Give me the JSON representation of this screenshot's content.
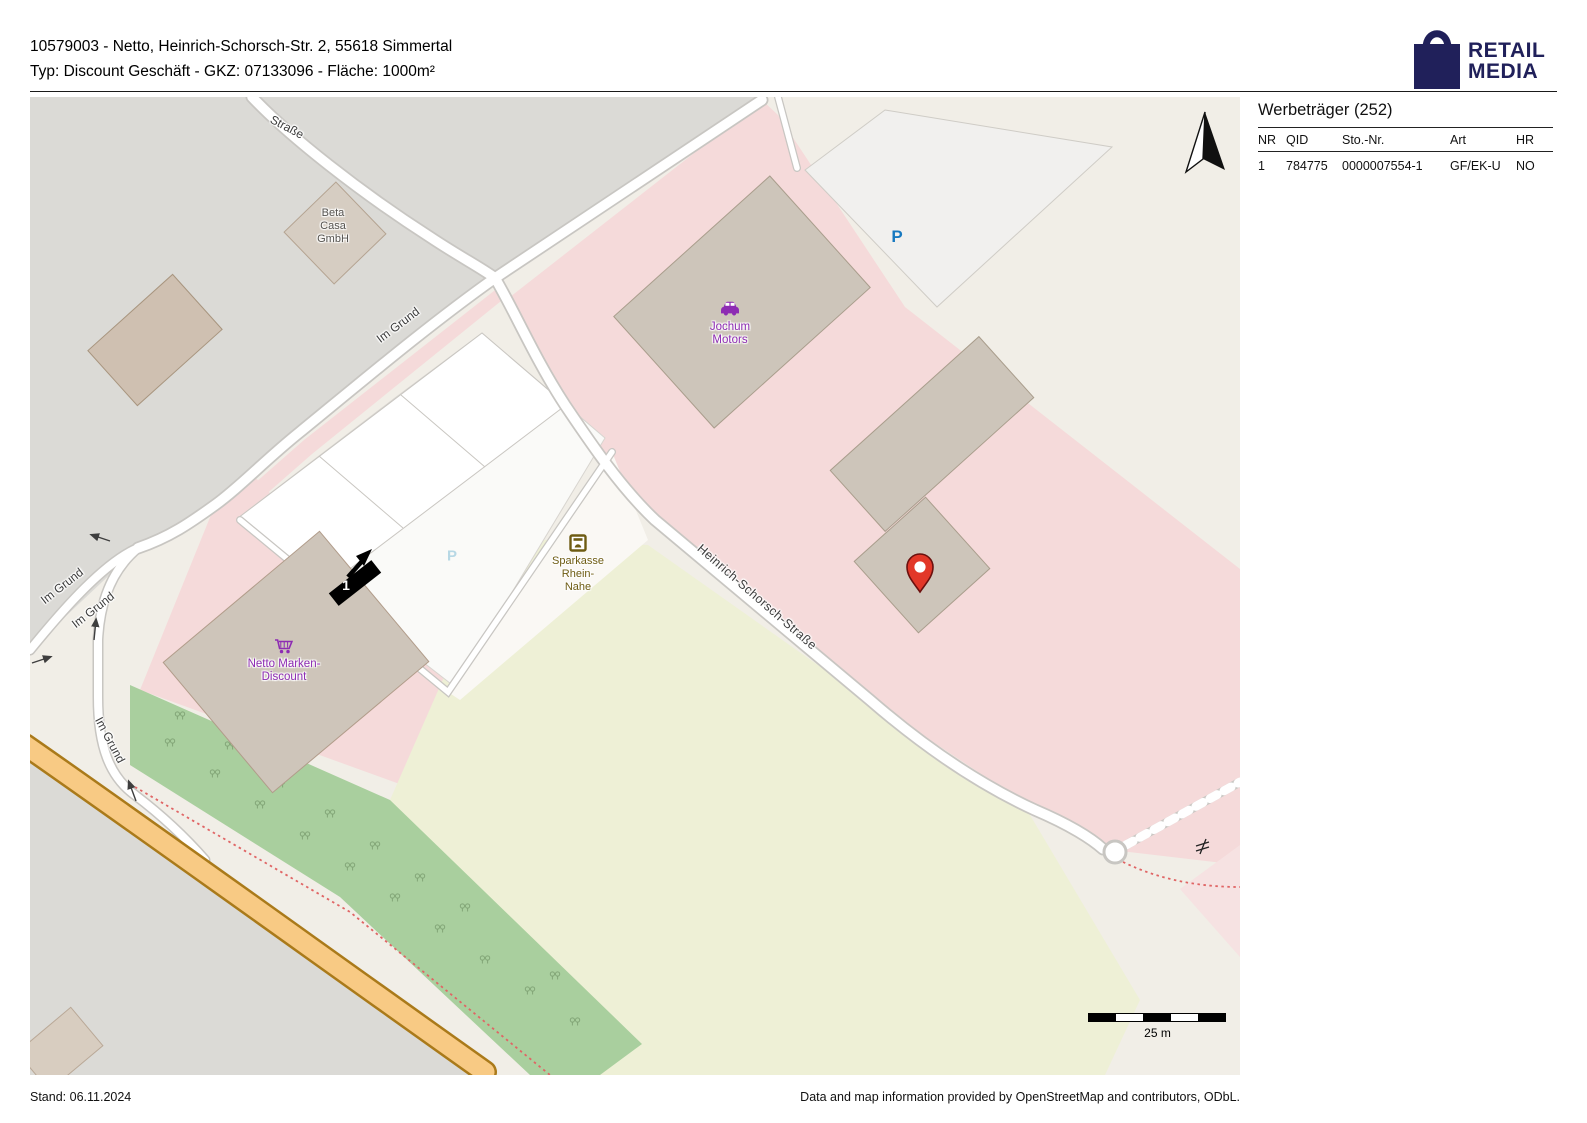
{
  "header": {
    "line1": "10579003 - Netto, Heinrich-Schorsch-Str. 2, 55618 Simmertal",
    "line2": "Typ: Discount Geschäft - GKZ: 07133096 - Fläche: 1000m²"
  },
  "logo": {
    "word1": "RETAIL",
    "word2": "MEDIA",
    "color": "#20205a"
  },
  "panel": {
    "title": "Werbeträger (252)",
    "columns": [
      "NR",
      "QID",
      "Sto.-Nr.",
      "Art",
      "HR"
    ],
    "rows": [
      {
        "nr": "1",
        "qid": "784775",
        "sto_nr": "0000007554-1",
        "art": "GF/EK-U",
        "hr": "NO"
      }
    ]
  },
  "map": {
    "marker_number": "1",
    "scale_label": "25 m",
    "parking_label": "P",
    "street_labels": {
      "strasse": "Straße",
      "im_grund": "Im Grund",
      "heinrich_schorsch": "Heinrich-Schorsch-Straße"
    },
    "poi_labels": {
      "beta_casa": [
        "Beta",
        "Casa",
        "GmbH"
      ],
      "jochum": [
        "Jochum",
        "Motors"
      ],
      "sparkasse": [
        "Sparkasse",
        "Rhein-",
        "Nahe"
      ],
      "netto": [
        "Netto Marken-",
        "Discount"
      ]
    },
    "colors": {
      "retail_area": "#f5dada",
      "industrial_area": "#dbdad6",
      "building": "#cdc5ba",
      "field": "#eef0d6",
      "scrub": "#a9cf9e",
      "road_orange": "#f8ca84",
      "poi_purple": "#8d2bb3",
      "bank_brown": "#6e5c13",
      "parking_blue": "#1779c0",
      "pin_red": "#e23728"
    }
  },
  "footer": {
    "stand": "Stand: 06.11.2024",
    "attribution": "Data and map information provided by OpenStreetMap and contributors, ODbL."
  }
}
